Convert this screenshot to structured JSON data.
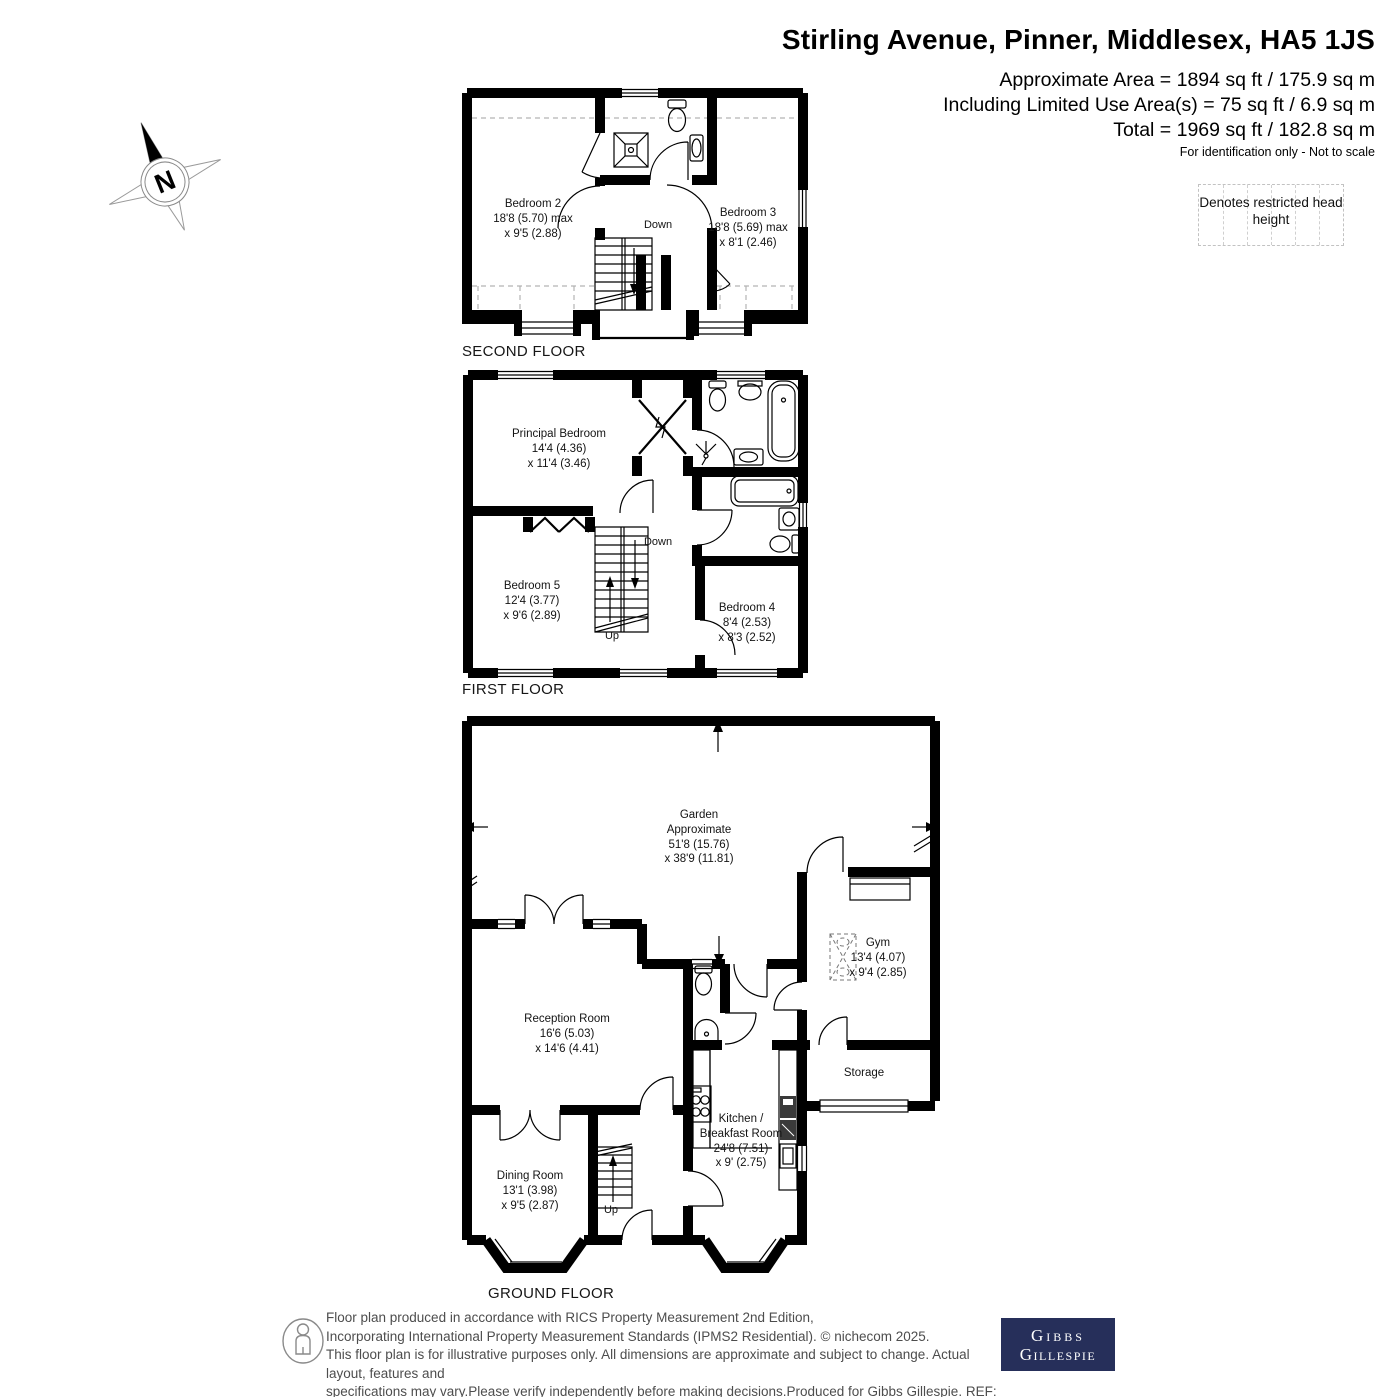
{
  "header": {
    "title": "Stirling Avenue, Pinner, Middlesex, HA5 1JS",
    "area_line1": "Approximate Area = 1894 sq ft / 175.9 sq m",
    "area_line2": "Including Limited Use Area(s) = 75 sq ft / 6.9 sq m",
    "area_line3": "Total = 1969 sq ft / 182.8 sq m",
    "disclaimer": "For identification only - Not to scale"
  },
  "compass": {
    "north_label": "N"
  },
  "legend": {
    "restricted_text": "Denotes restricted head height"
  },
  "floors": {
    "second": {
      "caption": "SECOND FLOOR",
      "rooms": {
        "bedroom2": {
          "name": "Bedroom 2",
          "dim1": "18'8 (5.70) max",
          "dim2": "x 9'5 (2.88)"
        },
        "bedroom3": {
          "name": "Bedroom 3",
          "dim1": "18'8 (5.69) max",
          "dim2": "x 8'1 (2.46)"
        }
      },
      "stairs": {
        "down": "Down"
      }
    },
    "first": {
      "caption": "FIRST FLOOR",
      "rooms": {
        "principal": {
          "name": "Principal Bedroom",
          "dim1": "14'4 (4.36)",
          "dim2": "x 11'4 (3.46)"
        },
        "bedroom5": {
          "name": "Bedroom 5",
          "dim1": "12'4 (3.77)",
          "dim2": "x 9'6 (2.89)"
        },
        "bedroom4": {
          "name": "Bedroom 4",
          "dim1": "8'4 (2.53)",
          "dim2": "x 8'3 (2.52)"
        }
      },
      "stairs": {
        "down": "Down",
        "up": "Up"
      }
    },
    "ground": {
      "caption": "GROUND FLOOR",
      "rooms": {
        "garden": {
          "name": "Garden",
          "name2": "Approximate",
          "dim1": "51'8 (15.76)",
          "dim2": "x 38'9 (11.81)"
        },
        "gym": {
          "name": "Gym",
          "dim1": "13'4 (4.07)",
          "dim2": "x 9'4 (2.85)"
        },
        "reception": {
          "name": "Reception Room",
          "dim1": "16'6 (5.03)",
          "dim2": "x 14'6 (4.41)"
        },
        "storage": {
          "name": "Storage"
        },
        "kitchen": {
          "name": "Kitchen /",
          "name2": "Breakfast Room",
          "dim1": "24'8 (7.51)",
          "dim2": "x 9' (2.75)"
        },
        "dining": {
          "name": "Dining Room",
          "dim1": "13'1 (3.98)",
          "dim2": "x 9'5 (2.87)"
        }
      },
      "stairs": {
        "up": "Up"
      }
    }
  },
  "footer": {
    "line1": "Floor plan produced in accordance with RICS Property Measurement 2nd Edition,",
    "line2": "Incorporating International Property Measurement Standards (IPMS2 Residential).   © nichecom 2025.",
    "line3": "This floor plan is for illustrative purposes only. All dimensions are approximate and subject to change. Actual layout, features and",
    "line4": "specifications may vary.Please verify independently before making decisions.Produced for Gibbs Gillespie.   REF: 1332451",
    "logo_line1": "Gibbs",
    "logo_line2": "Gillespie"
  },
  "colors": {
    "wall": "#000000",
    "logo_navy": "#262f5a",
    "footer_gray": "#4d4d4d",
    "dash_gray": "#b3b3b3"
  }
}
